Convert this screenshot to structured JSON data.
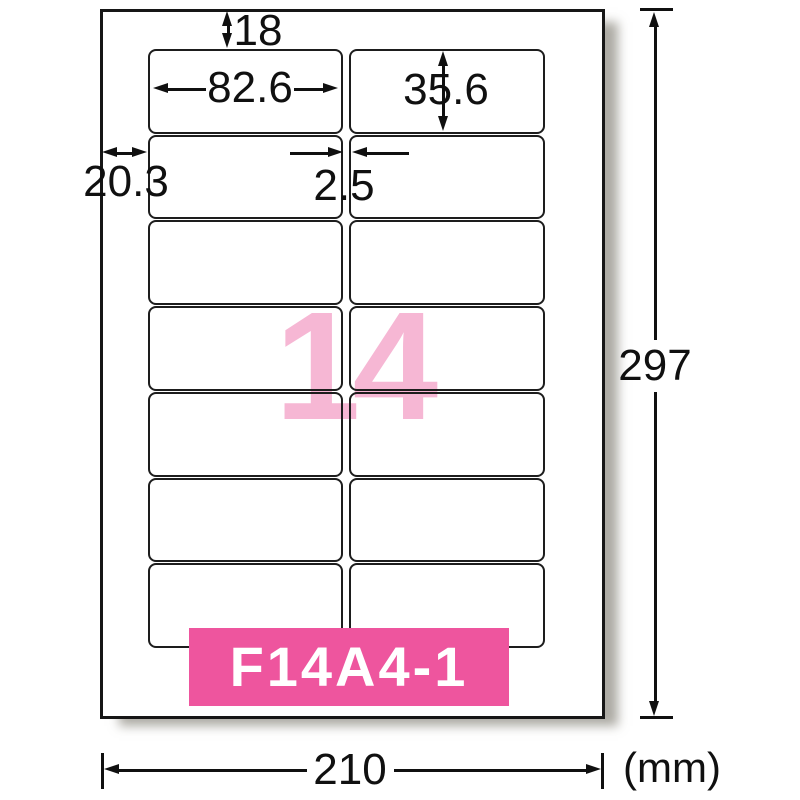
{
  "sheet": {
    "count_label": "14",
    "product_code": "F14A4-1",
    "rows": 7,
    "columns": 2,
    "unit": "(mm)",
    "colors": {
      "badge_pink": "#ee559e",
      "watermark_pink": "#f6b7d4",
      "line_black": "#101010"
    }
  },
  "dimensions": {
    "top_margin": "18",
    "label_width": "82.6",
    "label_height": "35.6",
    "left_margin": "20.3",
    "column_gap": "2.5",
    "page_height": "297",
    "page_width": "210"
  }
}
